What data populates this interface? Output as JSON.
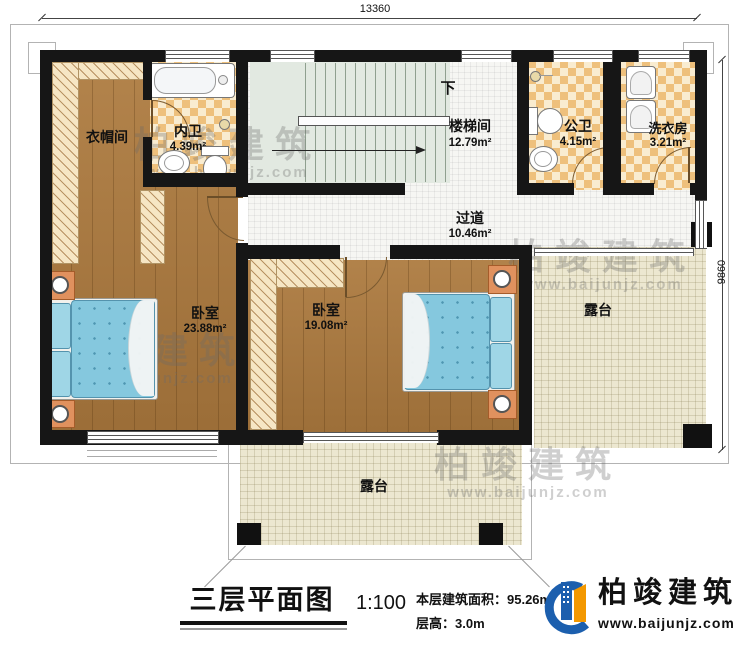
{
  "dimensions": {
    "top": "13360",
    "right": "9860"
  },
  "rooms": {
    "cloakroom": {
      "name": "衣帽间"
    },
    "bath_inner": {
      "name": "内卫",
      "area": "4.39m²"
    },
    "stairwell": {
      "name": "楼梯间",
      "area": "12.79m²",
      "down": "下"
    },
    "bath_public": {
      "name": "公卫",
      "area": "4.15m²"
    },
    "laundry": {
      "name": "洗衣房",
      "area": "3.21m²"
    },
    "corridor": {
      "name": "过道",
      "area": "10.46m²"
    },
    "bedroom1": {
      "name": "卧室",
      "area": "23.88m²"
    },
    "bedroom2": {
      "name": "卧室",
      "area": "19.08m²"
    },
    "terrace_right": {
      "name": "露台"
    },
    "terrace_bottom": {
      "name": "露台"
    }
  },
  "title": {
    "name": "三层平面图",
    "scale": "1:100",
    "floor_area": "本层建筑面积：95.26m²",
    "floor_height": "层高：3.0m"
  },
  "logo": {
    "name": "柏竣建筑",
    "website": "www.baijunjz.com"
  },
  "watermark": {
    "name": "柏竣建筑",
    "website": "www.baijunjz.com"
  },
  "colors": {
    "wall": "#161616",
    "wood_floor": "#ad7a3e",
    "bath_tile_orange": "#eec07c",
    "terrace_floor": "#ece7d0",
    "bed_blue": "#85c8de",
    "nightstand_orange": "#e0915e",
    "logo_blue": "#1c5fae",
    "logo_orange": "#f39800"
  }
}
